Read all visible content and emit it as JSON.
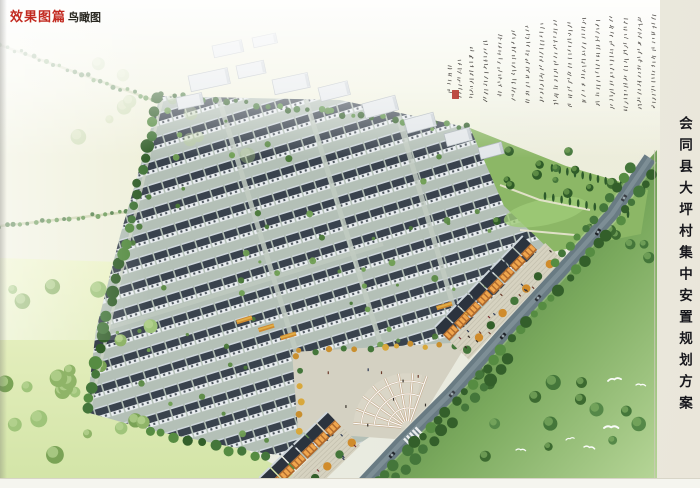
{
  "header": {
    "section_label": "效果图篇",
    "subtitle": "鸟瞰图"
  },
  "side_title": "会同县大坪村集中安置规划方案",
  "calligraphy": {
    "columns": [
      [
        651,
        14,
        96
      ],
      [
        637,
        16,
        94
      ],
      [
        623,
        18,
        92
      ],
      [
        609,
        16,
        95
      ],
      [
        595,
        20,
        88
      ],
      [
        581,
        18,
        90
      ],
      [
        567,
        22,
        84
      ],
      [
        553,
        20,
        86
      ],
      [
        539,
        24,
        80
      ],
      [
        525,
        26,
        78
      ],
      [
        511,
        30,
        72
      ],
      [
        497,
        34,
        66
      ],
      [
        483,
        40,
        60
      ],
      [
        469,
        46,
        52
      ],
      [
        457,
        60,
        36
      ],
      [
        447,
        64,
        30
      ]
    ],
    "seal": [
      452,
      90,
      7,
      9
    ]
  },
  "scene": {
    "colors": {
      "paper": "#e9eadf",
      "field_pale": "#eef0da",
      "meadow_left_top": "#edf3c9",
      "meadow_left_bottom": "#d2e4a6",
      "meadow_right_dark": "#49763d",
      "meadow_right_mid": "#7aa95d",
      "meadow_right_light": "#b7d698",
      "ground": "#b4c0b7",
      "roof": "#39424d",
      "roof_ridge": "#cfd7dd",
      "wall": "#e9edf0",
      "window": "#49525a",
      "road": "#697b83",
      "road_center": "#8b9ba1",
      "road_soft": "#e8ebe6",
      "shop_roof": "#2b333e",
      "shop_face": "#b06a2d",
      "shop_window": "#f0a64e",
      "sidewalk": "#d6d2c0",
      "sidewalk_line": "#c3bfad",
      "plaza": "#d4d1c2",
      "fan_tan": "#c5ab8c",
      "fan_white": "#ffffff",
      "park": "#8cb766",
      "lawn": "#9fca78",
      "path": "#e9e6d2",
      "poplar": "#2d5a2b",
      "tree_dark": "#335f2a",
      "tree_mid": "#44763a",
      "tree_light": "#568c42",
      "tree_autumn": "#d08c2c",
      "tree_yellow": "#d8a83c",
      "building_roof": "#e2e6e9",
      "building_edge": "#a9b1b8",
      "building_shade": "#c6cdd3",
      "cross_road": "#c2ccc2",
      "field_road": "#ccd3ae",
      "ink": "#43403c",
      "seal": "#b5342b",
      "bird": "#ffffff",
      "header_red": "#c22a20",
      "header_black": "#2a2922",
      "title_black": "#17171c"
    },
    "housing": {
      "clip": "160,96 340,100 470,128 548,250 520,296 462,344 404,414 332,462 256,452 150,430 86,412 96,330 120,236 142,160",
      "angle": -17,
      "pitch_x": 14.6,
      "pitch_y": 22,
      "unit_w": 13,
      "cross_roads": [
        [
          218,
          96,
          323,
          440
        ],
        [
          306,
          100,
          411,
          444
        ],
        [
          398,
          116,
          498,
          460
        ]
      ],
      "long_road": [
        96,
        332,
        383,
        244
      ],
      "bush_count": 90,
      "bush_box": [
        92,
        104,
        450,
        352
      ],
      "gardens": [
        [
          236,
          320
        ],
        [
          258,
          328
        ],
        [
          280,
          336
        ],
        [
          436,
          306
        ],
        [
          458,
          314
        ],
        [
          318,
          372
        ]
      ]
    },
    "buildings": [
      [
        188,
        76,
        40,
        16,
        -12
      ],
      [
        236,
        66,
        28,
        13,
        -12
      ],
      [
        272,
        80,
        36,
        15,
        -12
      ],
      [
        176,
        98,
        26,
        12,
        -12
      ],
      [
        318,
        88,
        30,
        14,
        -14
      ],
      [
        362,
        104,
        34,
        15,
        -15
      ],
      [
        404,
        120,
        30,
        14,
        -15
      ],
      [
        444,
        134,
        26,
        13,
        -15
      ],
      [
        478,
        148,
        24,
        12,
        -15
      ],
      [
        212,
        46,
        30,
        12,
        -12
      ],
      [
        252,
        38,
        24,
        10,
        -12
      ]
    ],
    "park": {
      "poly": "470,128 566,166 648,190 641,234 552,252 504,206",
      "paths": [
        [
          500,
          185,
          540,
          200,
          590,
          210
        ],
        [
          520,
          230,
          575,
          235
        ]
      ],
      "lawn": [
        545,
        212,
        42,
        13,
        -12
      ],
      "poplars": [
        [
          552,
          168,
          644,
          190,
          13
        ],
        [
          545,
          196,
          628,
          214,
          11
        ]
      ]
    },
    "plaza": {
      "poly": "292,352 468,342 408,440 298,432",
      "fan": {
        "cx": 408,
        "cy": 428,
        "r": 55,
        "a0": 185,
        "a1": 290,
        "spokes": 7,
        "rings": [
          20,
          34,
          47
        ]
      },
      "edge_trees_top": [
        300,
        352,
        455,
        344,
        12
      ],
      "edge_trees_left": [
        298,
        356,
        300,
        430,
        6
      ],
      "people_box": [
        312,
        362,
        118,
        62
      ],
      "people_n": 9
    },
    "commercial": [
      {
        "tx": 477,
        "ty": 305,
        "rot": -46,
        "x0": -45,
        "x1": 92,
        "people": 16
      },
      {
        "tx": 320,
        "ty": 440,
        "rot": -44,
        "x0": -70,
        "x1": 25,
        "people": 9
      }
    ],
    "road": {
      "pts": [
        [
          355,
          492
        ],
        [
          400,
          444
        ],
        [
          450,
          394
        ],
        [
          505,
          332
        ],
        [
          562,
          270
        ],
        [
          612,
          214
        ],
        [
          650,
          158
        ]
      ],
      "width": 13,
      "crosswalk": [
        413,
        438,
        -44
      ]
    },
    "cars": [
      [
        392,
        455,
        -47,
        "#23282e"
      ],
      [
        452,
        394,
        -48,
        "#3a3f46"
      ],
      [
        503,
        336,
        -48,
        "#20252b"
      ],
      [
        538,
        298,
        -49,
        "#2c3138"
      ],
      [
        598,
        232,
        -56,
        "#1e2126"
      ],
      [
        624,
        198,
        -56,
        "#383d44"
      ]
    ],
    "field_roads": [
      [
        0,
        226,
        210,
        203
      ],
      [
        0,
        45,
        214,
        122
      ]
    ],
    "meadow_left_poly": "0,258 120,262 188,300 226,372 250,452 300,478 300,488 0,488",
    "meadow_right_poly": "372,478 398,446 448,396 506,334 562,270 612,214 650,158 657,150 657,478",
    "tree_regions": [
      {
        "box": [
          5,
          285,
          160,
          185
        ],
        "n": 22,
        "r": [
          4,
          9
        ],
        "cols": [
          "#8fb468",
          "#7aa356",
          "#9fc47a"
        ],
        "hl": "#b9d694",
        "op": 1
      },
      {
        "box": [
          430,
          370,
          210,
          95
        ],
        "n": 15,
        "r": [
          4,
          8
        ],
        "cols": [
          "#3c6a30",
          "#44763a",
          "#558848"
        ],
        "hl": "#7fae62",
        "op": 1
      },
      {
        "box": [
          595,
          180,
          55,
          85
        ],
        "n": 7,
        "r": [
          4,
          7
        ],
        "cols": [
          "#3c6a30",
          "#44763a"
        ],
        "hl": "#7fae62",
        "op": 1
      },
      {
        "box": [
          70,
          60,
          260,
          120
        ],
        "n": 12,
        "r": [
          4,
          8
        ],
        "cols": [
          "#b9cf96",
          "#a3c283"
        ],
        "hl": "#cfe0ae",
        "op": 0.4
      },
      {
        "box": [
          480,
          148,
          150,
          80
        ],
        "n": 14,
        "r": [
          3,
          5
        ],
        "cols": [
          "#2f5c28",
          "#44763a"
        ],
        "hl": "#6fa050",
        "op": 1
      }
    ],
    "tree_chains": {
      "left_boundary": {
        "a": [
          86,
          410
        ],
        "b": [
          158,
          98
        ],
        "n": 27,
        "r": [
          4,
          7
        ]
      },
      "top_hedge": {
        "a": [
          162,
          95
        ],
        "b": [
          468,
          127
        ],
        "n": 30,
        "r": [
          2,
          3.5
        ]
      },
      "bottom": {
        "a": [
          150,
          430
        ],
        "b": [
          305,
          468
        ],
        "n": 13,
        "r": [
          3.5,
          5.5
        ]
      }
    },
    "birds": [
      [
        608,
        381,
        1.1,
        -8
      ],
      [
        636,
        385,
        0.8,
        5
      ],
      [
        604,
        428,
        1.2,
        0
      ],
      [
        584,
        447,
        0.9,
        10
      ],
      [
        566,
        440,
        0.7,
        -12
      ],
      [
        516,
        450,
        0.8,
        4
      ]
    ]
  }
}
